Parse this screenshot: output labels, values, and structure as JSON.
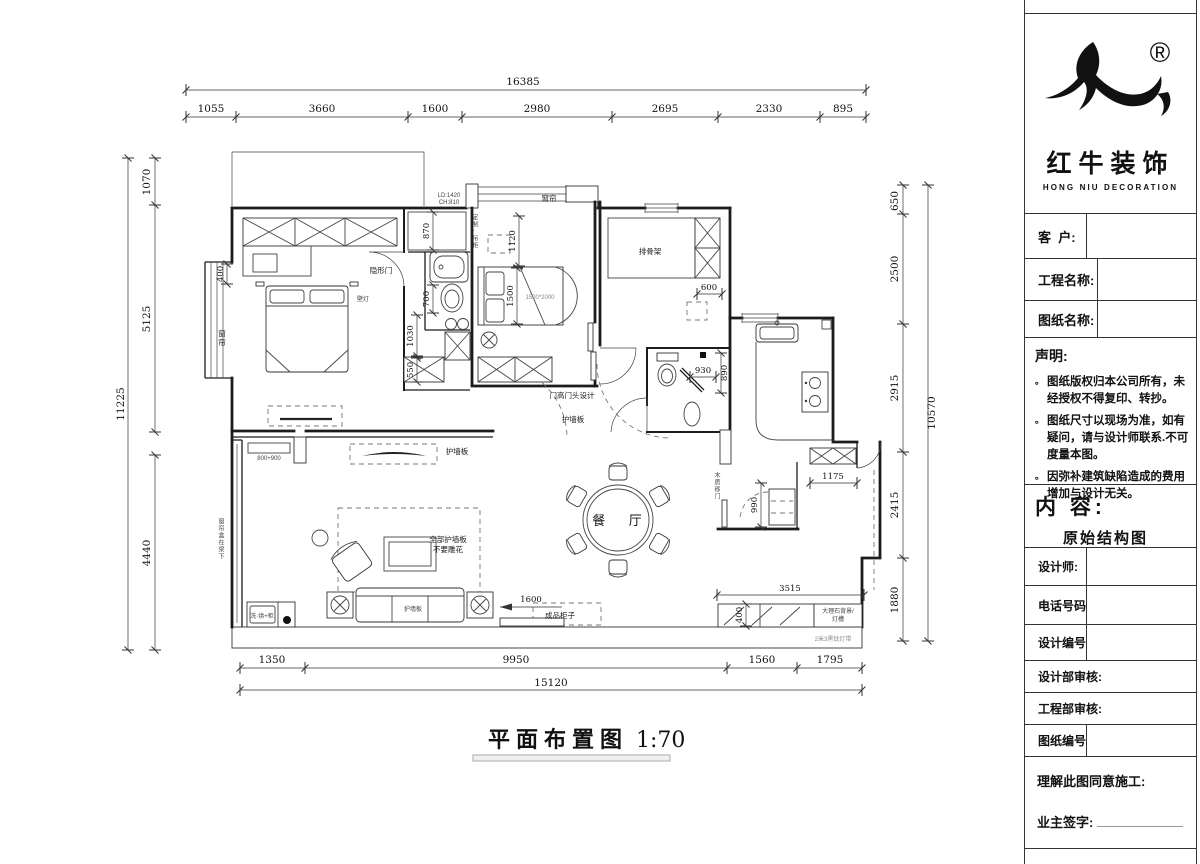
{
  "logo": {
    "cn": "红牛装饰",
    "en": "HONG NIU DECORATION",
    "reg": "®"
  },
  "tb": {
    "customer": "客  户:",
    "project": "工程名称:",
    "drawing": "图纸名称:",
    "stmt_title": "声明:",
    "stmt": [
      "图纸版权归本公司所有，未经授权不得复印、转抄。",
      "图纸尺寸以现场为准，如有疑问，请与设计师联系.不可度量本图。",
      "因弥补建筑缺陷造成的费用增加与设计无关。"
    ],
    "content": "内  容:",
    "content_val": "原始结构图",
    "designer": "设计师:",
    "phone": "电话号码",
    "design_no": "设计编号",
    "design_review": "设计部审核:",
    "eng_review": "工程部审核:",
    "sheet_no": "图纸编号",
    "agree": "理解此图同意施工:",
    "sign": "业主签字:"
  },
  "title": {
    "name": "平面布置图",
    "scale": "1:70"
  },
  "dims": {
    "top_total": "16385",
    "top": [
      "1055",
      "3660",
      "1600",
      "2980",
      "2695",
      "2330",
      "895"
    ],
    "left_total": "11225",
    "left": [
      "1070",
      "5125",
      "4440"
    ],
    "right_total": "10570",
    "right": [
      "650",
      "2500",
      "2915",
      "2415",
      "1880"
    ],
    "bottom_total": "15120",
    "bottom": [
      "1350",
      "9950",
      "1560",
      "1795"
    ],
    "d870": "870",
    "d700": "700",
    "d1030": "1030",
    "d550": "550",
    "d400": "400",
    "d1120": "1120",
    "d1500": "1500",
    "d600": "600",
    "d930": "930",
    "d890": "890",
    "d990": "990",
    "d1175": "1175",
    "d1600": "1600",
    "d3515": "3515",
    "d400b": "400",
    "niche": "800+900",
    "bedsize": "1500*2000",
    "ld": "LD:1420",
    "ch": "CH:810"
  },
  "notes": {
    "hidden_door": "隐形门",
    "wall_lamp": "壁灯",
    "curtain_bay": "窗帘",
    "curtain_win": "窗帘",
    "custom_cabinet": "定制·吊柜",
    "slat_frame": "排骨架",
    "door_head": "门高门头设计",
    "panel1": "护墙板",
    "panel2": "护墙板",
    "panel3": "护墙板",
    "all_panel": "全部护墙板",
    "no_carve": "不要雕花",
    "dining": "餐 厅",
    "beam_note": "窗帘盒在梁下",
    "sliding_door": "木质移门",
    "marble": "大理石背景/",
    "light_trough": "灯槽",
    "cabinet": "成品柜子",
    "light_strip": "2米3黑钛灯带",
    "washer": "洗·烘+柜"
  }
}
